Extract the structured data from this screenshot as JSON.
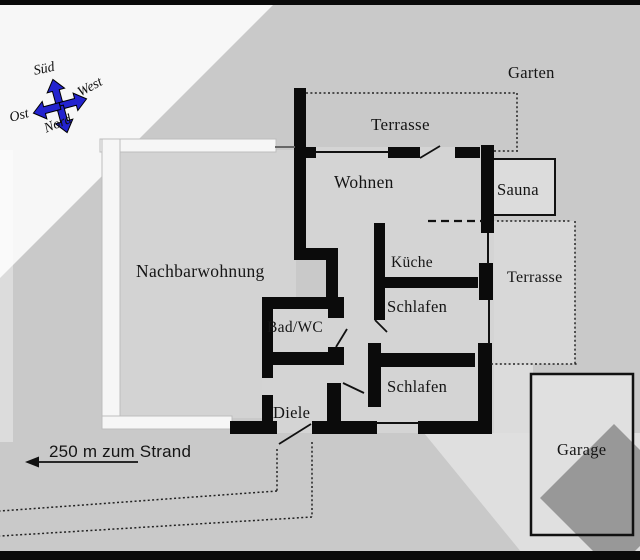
{
  "floorplan": {
    "rooms": {
      "garten": "Garten",
      "terrasse_top": "Terrasse",
      "wohnen": "Wohnen",
      "sauna": "Sauna",
      "kueche": "Küche",
      "terrasse_right": "Terrasse",
      "schlafen_upper": "Schlafen",
      "schlafen_lower": "Schlafen",
      "bad_wc": "Bad/WC",
      "diele": "Diele",
      "nachbarwohnung": "Nachbarwohnung",
      "garage": "Garage"
    },
    "compass": {
      "sued": "Süd",
      "west": "West",
      "ost": "Ost",
      "nord": "Nord"
    },
    "annotation": {
      "beach_distance": "250 m zum Strand"
    },
    "colors": {
      "wall": "#0b0b0b",
      "compass_blue": "#2323cf",
      "background": "#c9c9c9",
      "highlight_white": "#f7f7f7",
      "room_fill": "#d4d4d4",
      "dark_shape": "#989898"
    }
  }
}
